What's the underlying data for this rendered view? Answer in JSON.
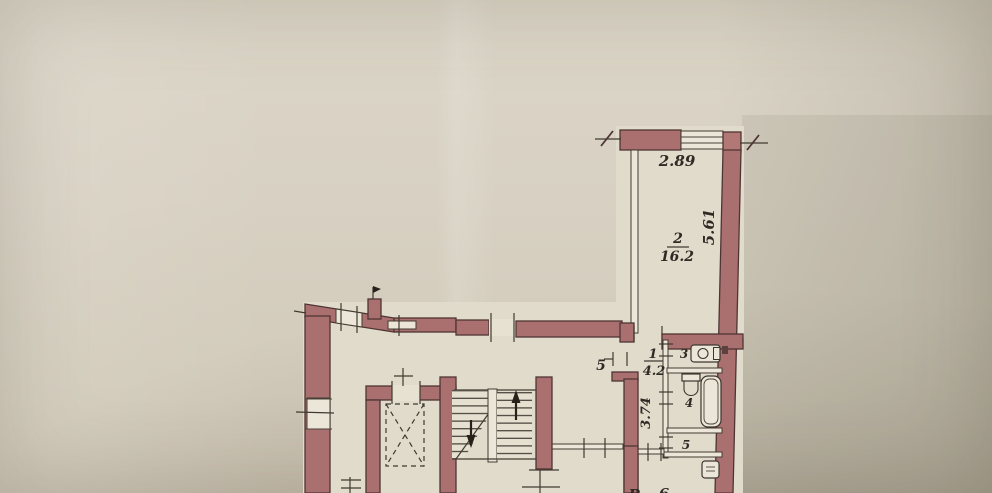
{
  "document": {
    "type": "scanned apartment floor plan",
    "colors": {
      "wall": "#a9706f",
      "paper": "#d5cec0",
      "line": "#403a31",
      "interior": "#e1dbcc"
    }
  },
  "rooms": {
    "room2": {
      "number": "2",
      "area": "16.2"
    },
    "room1": {
      "number": "1",
      "area": "4.2"
    },
    "room3": {
      "number": "3"
    },
    "room4": {
      "number": "4"
    },
    "room5_closet": {
      "number": "5"
    },
    "room5_living": {
      "number": "5"
    }
  },
  "dimensions": {
    "width_top": "2.89",
    "depth_right": "5.61",
    "hall_depth": "3.74"
  },
  "bottom_partial": {
    "left": "Р",
    "right": "6"
  }
}
